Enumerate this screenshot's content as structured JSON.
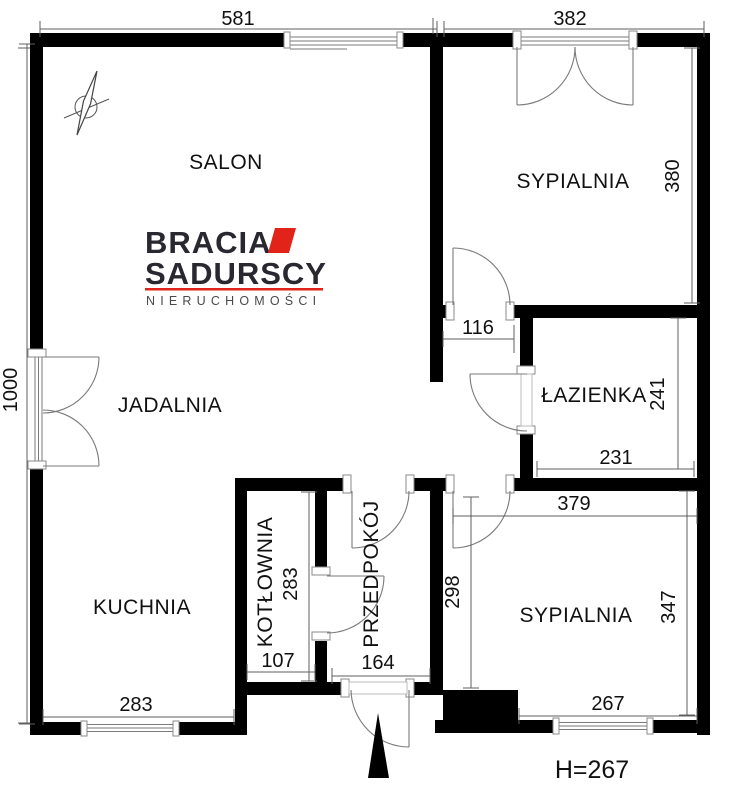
{
  "plan": {
    "rooms": {
      "salon": "SALON",
      "bedroom1": "SYPIALNIA",
      "dining": "JADALNIA",
      "bathroom": "ŁAZIENKA",
      "kitchen": "KUCHNIA",
      "boiler": "KOTŁOWNIA",
      "hall": "PRZEDPOKÓJ",
      "bedroom2": "SYPIALNIA"
    },
    "dims": {
      "salon_width": "581",
      "bedroom1_width": "382",
      "bedroom1_height": "380",
      "total_height": "1000",
      "corridor_width": "116",
      "bathroom_height": "241",
      "bathroom_width": "231",
      "bedroom2_width_top": "379",
      "bedroom2_height_left": "298",
      "bedroom2_height_right": "347",
      "bedroom2_width_bottom": "267",
      "kitchen_width": "283",
      "boiler_height": "283",
      "boiler_width": "107",
      "hall_width": "164"
    },
    "ceiling_height": "H=267"
  },
  "logo": {
    "brand_line1": "BRACIA",
    "brand_line2": "SADURSCY",
    "tagline": "NIERUCHOMOŚCI",
    "accent_color": "#e2231a"
  },
  "colors": {
    "wall": "#000000",
    "detail_line": "#707070",
    "text": "#111111"
  }
}
